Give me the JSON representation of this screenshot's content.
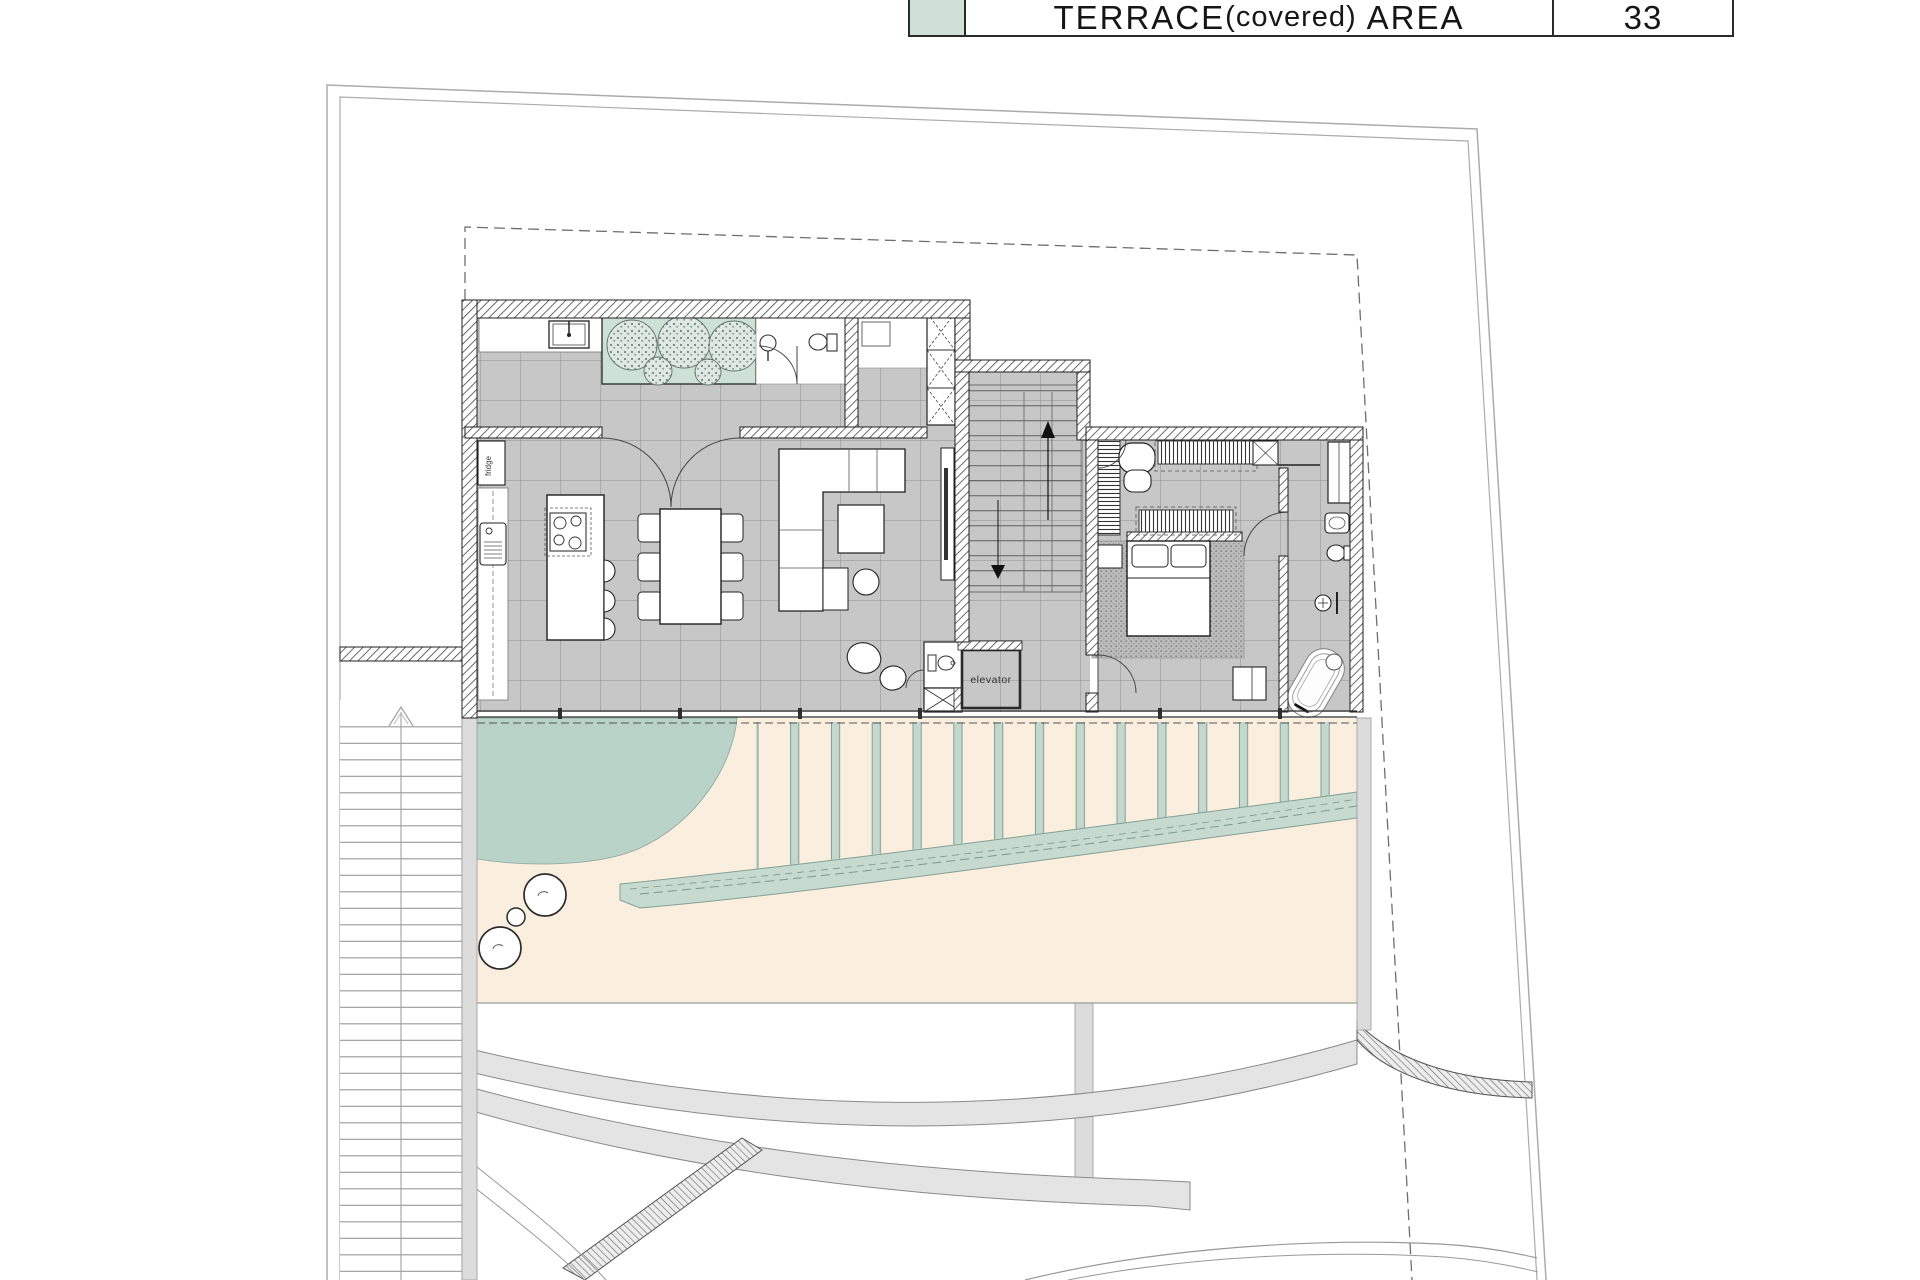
{
  "legend": {
    "title_main": "TERRACE",
    "title_paren": "(covered)",
    "title_tail": "AREA",
    "value": "33",
    "swatch_color": "#cfe0d6"
  },
  "labels": {
    "elevator": "elevator",
    "fridge": "fridge"
  },
  "colors": {
    "planter_green": "#cde1d7",
    "lawn_green": "#b9d3c8",
    "pergola_slat_green": "#c3d8ce",
    "water_band_green": "#c6dacf",
    "terrace_beige": "#faefdf",
    "floor_tile_gray": "#c7c7c7",
    "wall_line": "#1f1f1f",
    "boundary_gray": "#ababab"
  }
}
